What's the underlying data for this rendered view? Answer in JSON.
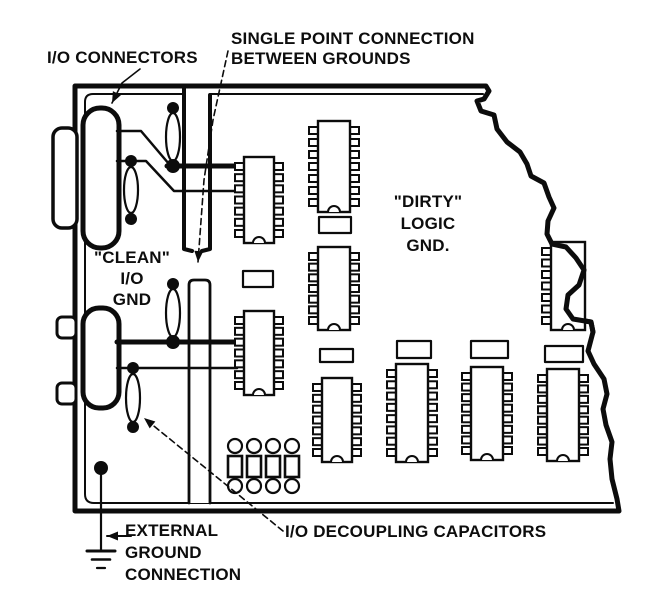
{
  "labels": {
    "io_connectors": "I/O CONNECTORS",
    "single_point_line1": "SINGLE POINT CONNECTION",
    "single_point_line2": "BETWEEN GROUNDS",
    "clean_line1": "\"CLEAN\"",
    "clean_line2": "I/O",
    "clean_line3": "GND",
    "dirty_line1": "\"DIRTY\"",
    "dirty_line2": "LOGIC",
    "dirty_line3": "GND.",
    "external_line1": "EXTERNAL",
    "external_line2": "GROUND",
    "external_line3": "CONNECTION",
    "decoupling": "I/O DECOUPLING CAPACITORS"
  },
  "colors": {
    "ink": "#0c0c0c",
    "paper": "#ffffff"
  },
  "diagram": {
    "width": 646,
    "height": 597,
    "shapes": [
      {
        "type": "path",
        "name": "board-outline",
        "sw": 5,
        "fill": "paper",
        "d": "M75,86 L486,86 L489,91 L484,99 L477,101 L481,111 L494,115 L497,129 L507,142 L520,152 L527,164 L531,176 L544,183 L549,197 L554,208 L548,221 L547,234 L552,244 L566,247 L576,258 L584,270 L579,285 L568,295 L566,309 L573,319 L591,322 L593,332 L588,351 L594,364 L604,379 L607,394 L603,409 L606,425 L612,442 L610,459 L612,479 L617,499 L619,511 L75,511 Z"
      },
      {
        "type": "path",
        "name": "clean-region-border",
        "sw": 2,
        "d": "M184,94 L93,94 Q85,94 85,102 L85,494 Q85,503 94,503 L188,503"
      },
      {
        "type": "path",
        "name": "dirty-region-top-border",
        "sw": 2,
        "d": "M210,94 L483,94"
      },
      {
        "type": "path",
        "name": "board-bottom-inner-line",
        "sw": 2,
        "d": "M188,503 L613,503"
      },
      {
        "type": "line",
        "name": "ground-slot-left-edge",
        "sw": 4,
        "pts": [
          [
            184,
            87
          ],
          [
            184,
            249
          ],
          [
            192,
            251
          ]
        ]
      },
      {
        "type": "line",
        "name": "ground-slot-right-edge",
        "sw": 4,
        "pts": [
          [
            210,
            95
          ],
          [
            210,
            249
          ],
          [
            202,
            251
          ]
        ]
      },
      {
        "type": "path",
        "name": "ground-slot-lower-bar",
        "sw": 2.8,
        "fill": "paper",
        "d": "M189,503 L189,285 Q189,280 194,280 L205,280 Q210,280 210,285 L210,503"
      },
      {
        "type": "rrect",
        "name": "io-connector-top-flange",
        "x": 53,
        "y": 128,
        "w": 24,
        "h": 100,
        "rx": 9,
        "sw": 3.5,
        "fill": "paper"
      },
      {
        "type": "rrect",
        "name": "io-connector-top-body",
        "x": 83,
        "y": 108,
        "w": 36,
        "h": 140,
        "rx": 17,
        "sw": 5,
        "fill": "paper"
      },
      {
        "type": "rrect",
        "name": "io-connector-bottom-flange-upper",
        "x": 57,
        "y": 317,
        "w": 19,
        "h": 21,
        "rx": 5,
        "sw": 3,
        "fill": "paper"
      },
      {
        "type": "rrect",
        "name": "io-connector-bottom-flange-lower",
        "x": 57,
        "y": 383,
        "w": 19,
        "h": 21,
        "rx": 5,
        "sw": 3,
        "fill": "paper"
      },
      {
        "type": "rrect",
        "name": "io-connector-bottom-body",
        "x": 83,
        "y": 308,
        "w": 36,
        "h": 100,
        "rx": 16,
        "sw": 5,
        "fill": "paper"
      },
      {
        "type": "line",
        "name": "wire-top-signal-1",
        "sw": 2.5,
        "pts": [
          [
            117,
            131
          ],
          [
            141,
            131
          ],
          [
            169,
            164
          ]
        ]
      },
      {
        "type": "line",
        "name": "wire-top-ground-thick",
        "sw": 5,
        "pts": [
          [
            167,
            166
          ],
          [
            237,
            166
          ]
        ]
      },
      {
        "type": "line",
        "name": "wire-top-signal-2",
        "sw": 2.5,
        "pts": [
          [
            117,
            161
          ],
          [
            146,
            161
          ],
          [
            174,
            191
          ],
          [
            237,
            191
          ]
        ]
      },
      {
        "type": "line",
        "name": "wire-bottom-ground-thick",
        "sw": 5,
        "pts": [
          [
            117,
            342
          ],
          [
            237,
            342
          ]
        ]
      },
      {
        "type": "line",
        "name": "wire-bottom-signal",
        "sw": 2.5,
        "pts": [
          [
            117,
            368
          ],
          [
            237,
            368
          ]
        ]
      },
      {
        "type": "dot",
        "name": "junction-dot",
        "x": 173,
        "y": 108,
        "r": 6
      },
      {
        "type": "ecap",
        "name": "io-capacitor-1",
        "cx": 173,
        "cy": 137,
        "rx": 7,
        "ry": 24
      },
      {
        "type": "dot",
        "name": "junction-dot",
        "x": 173,
        "y": 166,
        "r": 7
      },
      {
        "type": "dot",
        "name": "junction-dot",
        "x": 131,
        "y": 161,
        "r": 6
      },
      {
        "type": "ecap",
        "name": "io-capacitor-2",
        "cx": 131,
        "cy": 190,
        "rx": 7,
        "ry": 23
      },
      {
        "type": "dot",
        "name": "junction-dot",
        "x": 131,
        "y": 219,
        "r": 6
      },
      {
        "type": "dot",
        "name": "junction-dot",
        "x": 173,
        "y": 284,
        "r": 6
      },
      {
        "type": "ecap",
        "name": "io-capacitor-3",
        "cx": 173,
        "cy": 313,
        "rx": 7,
        "ry": 24
      },
      {
        "type": "dot",
        "name": "junction-dot",
        "x": 173,
        "y": 342,
        "r": 7
      },
      {
        "type": "dot",
        "name": "junction-dot",
        "x": 133,
        "y": 368,
        "r": 6
      },
      {
        "type": "ecap",
        "name": "io-capacitor-4",
        "cx": 133,
        "cy": 398,
        "rx": 7,
        "ry": 24
      },
      {
        "type": "dot",
        "name": "junction-dot",
        "x": 133,
        "y": 427,
        "r": 6
      },
      {
        "type": "dip",
        "name": "ic-clean-1",
        "x": 244,
        "y": 157,
        "w": 30,
        "h": 86,
        "pins": 7
      },
      {
        "type": "rrect",
        "name": "passive-component",
        "x": 243,
        "y": 271,
        "w": 30,
        "h": 16,
        "rx": 0,
        "sw": 2.2,
        "fill": "paper"
      },
      {
        "type": "dip",
        "name": "ic-clean-2",
        "x": 244,
        "y": 311,
        "w": 30,
        "h": 84,
        "pins": 7
      },
      {
        "type": "dip",
        "name": "ic-logic-1",
        "x": 318,
        "y": 121,
        "w": 32,
        "h": 91,
        "pins": 7
      },
      {
        "type": "rrect",
        "name": "passive-component",
        "x": 319,
        "y": 217,
        "w": 32,
        "h": 16,
        "rx": 0,
        "sw": 2.2,
        "fill": "paper"
      },
      {
        "type": "dip",
        "name": "ic-logic-2",
        "x": 318,
        "y": 247,
        "w": 32,
        "h": 83,
        "pins": 7
      },
      {
        "type": "rrect",
        "name": "bypass-capacitor",
        "x": 320,
        "y": 349,
        "w": 33,
        "h": 13,
        "rx": 0,
        "sw": 2.2,
        "fill": "paper"
      },
      {
        "type": "dip",
        "name": "ic-row-1",
        "x": 322,
        "y": 378,
        "w": 30,
        "h": 84,
        "pins": 7
      },
      {
        "type": "rrect",
        "name": "bypass-capacitor",
        "x": 397,
        "y": 341,
        "w": 34,
        "h": 17,
        "rx": 0,
        "sw": 2.2,
        "fill": "paper"
      },
      {
        "type": "dip",
        "name": "ic-row-2",
        "x": 396,
        "y": 364,
        "w": 32,
        "h": 98,
        "pins": 8
      },
      {
        "type": "rrect",
        "name": "bypass-capacitor",
        "x": 471,
        "y": 341,
        "w": 37,
        "h": 17,
        "rx": 0,
        "sw": 2.2,
        "fill": "paper"
      },
      {
        "type": "dip",
        "name": "ic-row-3",
        "x": 471,
        "y": 367,
        "w": 32,
        "h": 93,
        "pins": 8
      },
      {
        "type": "rrect",
        "name": "bypass-capacitor",
        "x": 545,
        "y": 346,
        "w": 38,
        "h": 16,
        "rx": 0,
        "sw": 2.2,
        "fill": "paper"
      },
      {
        "type": "dip",
        "name": "ic-row-4",
        "x": 547,
        "y": 369,
        "w": 32,
        "h": 92,
        "pins": 8
      },
      {
        "type": "dip",
        "name": "ic-torn-edge",
        "x": 551,
        "y": 242,
        "w": 34,
        "h": 88,
        "pins": 7,
        "sides": "left"
      },
      {
        "type": "path",
        "name": "torn-edge-overlay",
        "sw": 5,
        "d": "M552,244 L566,247 L576,258 L584,270 L579,285 L568,295 L566,309 L573,319 L591,322 L593,332"
      },
      {
        "type": "dcap",
        "name": "decoupling-capacitor",
        "cx": 235,
        "top": 439
      },
      {
        "type": "dcap",
        "name": "decoupling-capacitor",
        "cx": 254,
        "top": 439
      },
      {
        "type": "dcap",
        "name": "decoupling-capacitor",
        "cx": 273,
        "top": 439
      },
      {
        "type": "dcap",
        "name": "decoupling-capacitor",
        "cx": 292,
        "top": 439
      },
      {
        "type": "dot",
        "name": "ground-via",
        "x": 101,
        "y": 468,
        "r": 7
      },
      {
        "type": "line",
        "name": "ground-stem",
        "sw": 2.2,
        "pts": [
          [
            101,
            468
          ],
          [
            101,
            551
          ]
        ]
      },
      {
        "type": "gnd",
        "name": "earth-ground-symbol",
        "x": 101,
        "y": 551
      },
      {
        "type": "arrow",
        "name": "external-ground-arrow",
        "sw": 2,
        "pts": [
          [
            131,
            536
          ],
          [
            107,
            536
          ]
        ]
      },
      {
        "type": "arrow",
        "name": "io-connectors-leader",
        "sw": 1.6,
        "pts": [
          [
            140,
            69
          ],
          [
            122,
            83
          ],
          [
            112,
            103
          ]
        ]
      },
      {
        "type": "arrow",
        "name": "single-point-leader",
        "sw": 1.6,
        "dash": "6,4",
        "pts": [
          [
            228,
            51
          ],
          [
            213,
            120
          ],
          [
            204,
            180
          ],
          [
            198,
            262
          ]
        ]
      },
      {
        "type": "arrow",
        "name": "decoupling-leader",
        "sw": 1.6,
        "dash": "6,4",
        "pts": [
          [
            283,
            531
          ],
          [
            144,
            418
          ]
        ]
      }
    ]
  }
}
